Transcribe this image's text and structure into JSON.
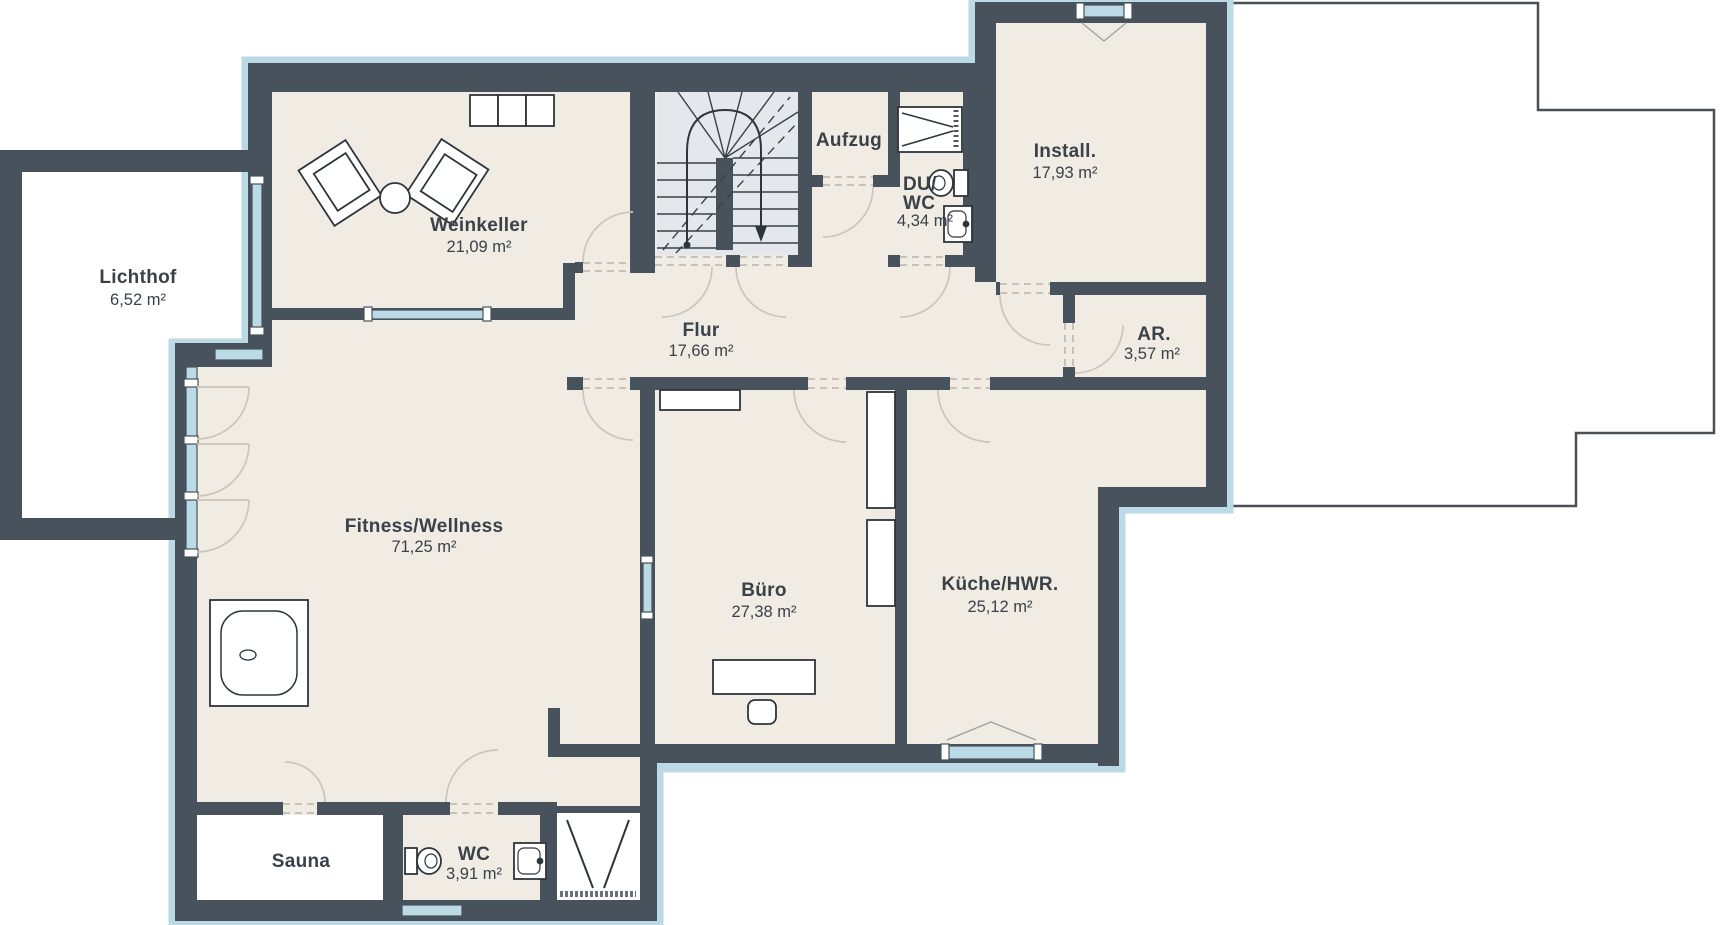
{
  "plan_title": "Kellergeschoss Grundriss",
  "colors": {
    "wall": "#47525c",
    "floor": "#f1ece3",
    "stair_floor": "#e4e8ec",
    "glazing": "#bcd9e6",
    "door_arc": "#ccc5b8",
    "opening_dash": "#c3bcae",
    "text": "#3a4148",
    "outline_upper_floor": "#4a5058",
    "white_room": "#ffffff"
  },
  "rooms": {
    "lichthof": {
      "name": "Lichthof",
      "area": "6,52 m²"
    },
    "weinkeller": {
      "name": "Weinkeller",
      "area": "21,09 m²"
    },
    "aufzug": {
      "name": "Aufzug"
    },
    "duwc": {
      "name_line1": "DU/",
      "name_line2": "WC",
      "area": "4,34 m²"
    },
    "install": {
      "name": "Install.",
      "area": "17,93 m²"
    },
    "flur": {
      "name": "Flur",
      "area": "17,66 m²"
    },
    "ar": {
      "name": "AR.",
      "area": "3,57 m²"
    },
    "fitness": {
      "name": "Fitness/Wellness",
      "area": "71,25 m²"
    },
    "buero": {
      "name": "Büro",
      "area": "27,38 m²"
    },
    "kueche": {
      "name": "Küche/HWR.",
      "area": "25,12 m²"
    },
    "sauna": {
      "name": "Sauna"
    },
    "wc": {
      "name": "WC",
      "area": "3,91 m²"
    }
  }
}
